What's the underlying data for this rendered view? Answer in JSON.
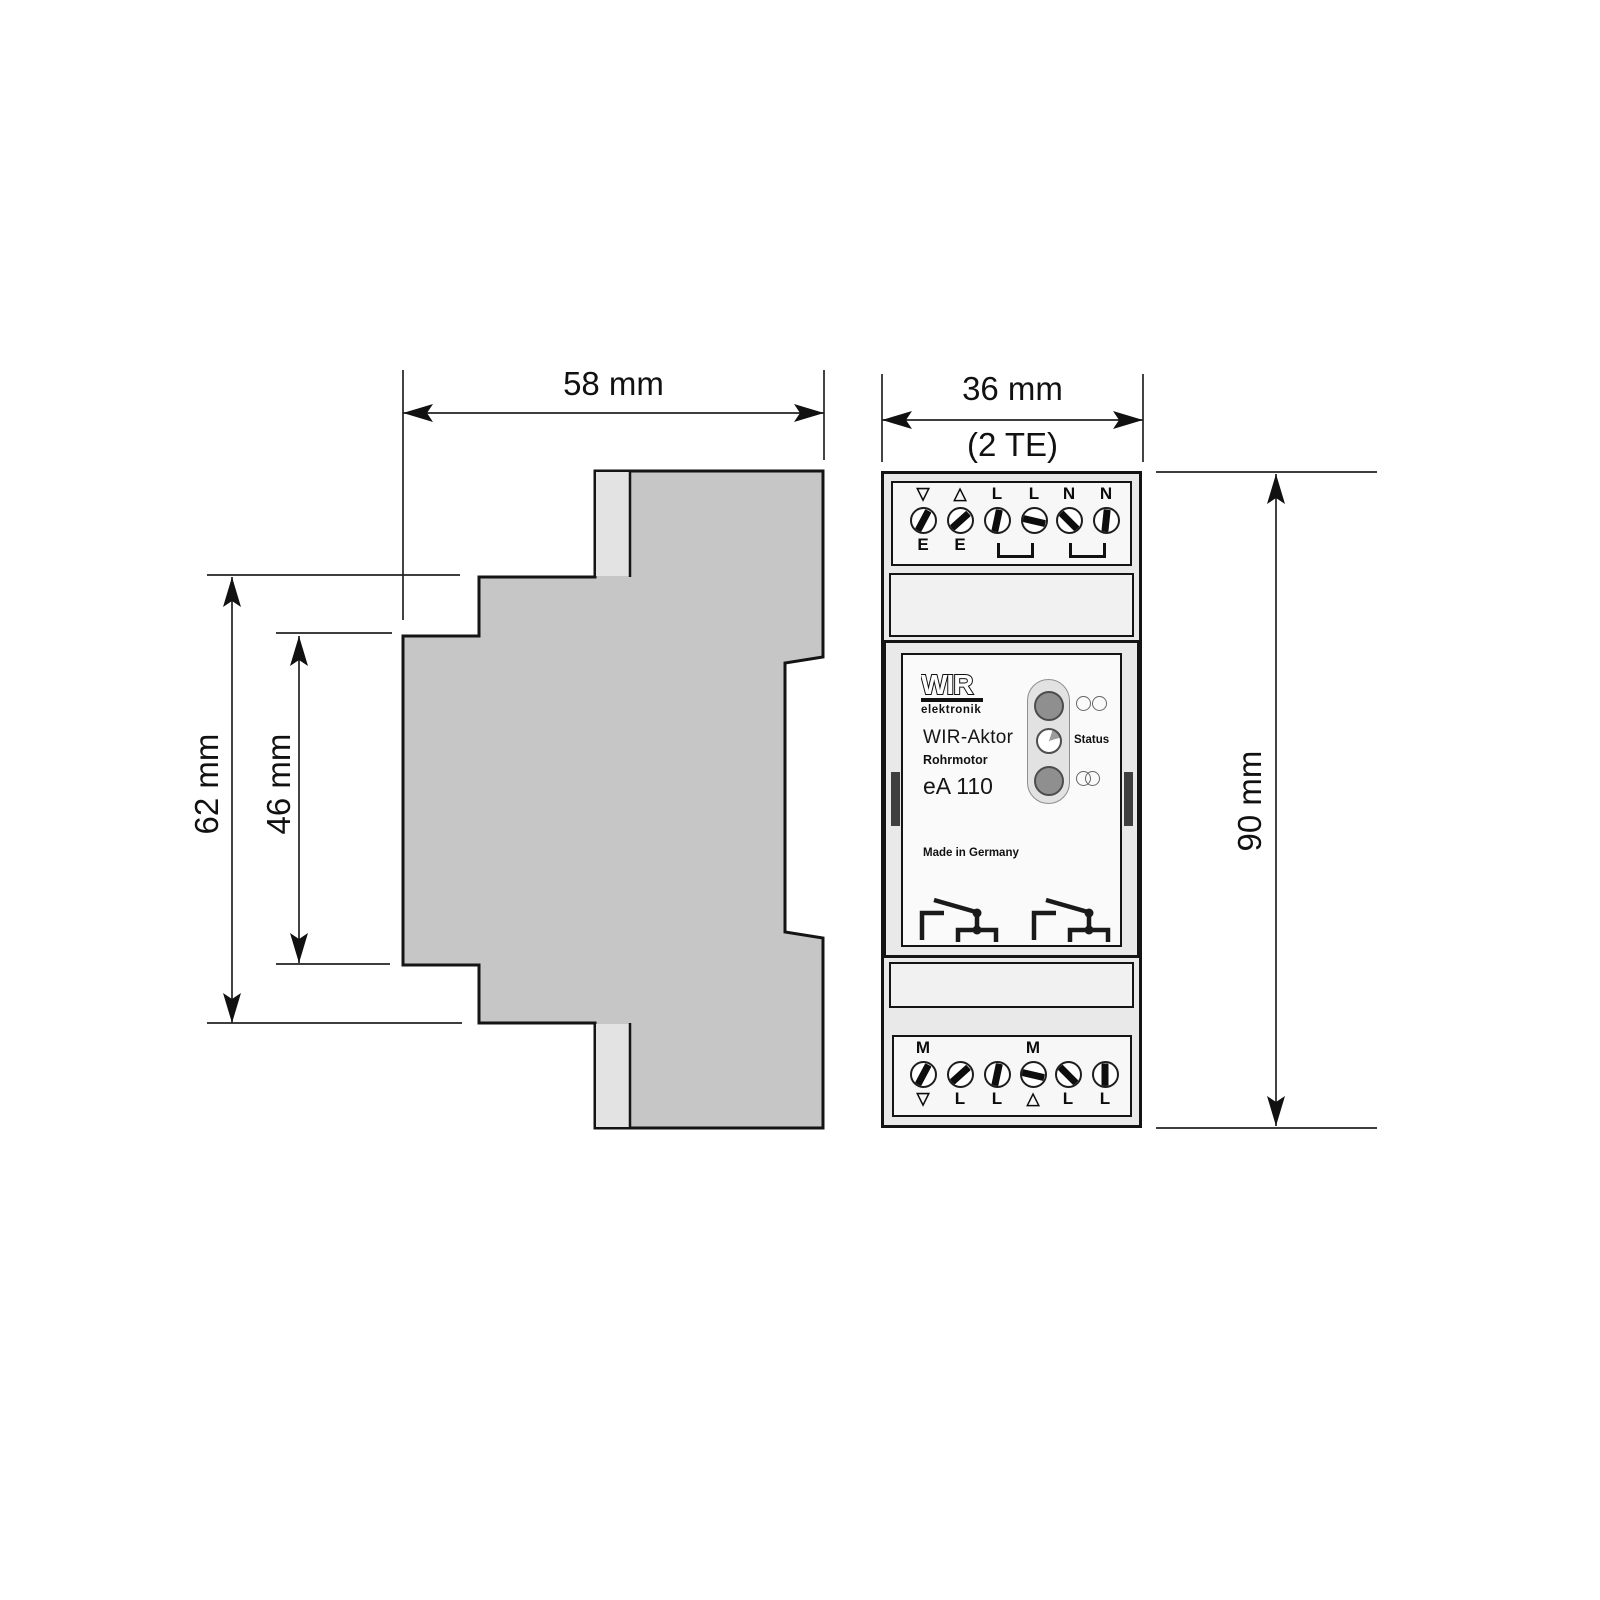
{
  "dimensions": {
    "side_width": "58 mm",
    "side_height_outer": "62 mm",
    "side_height_inner": "46 mm",
    "front_width": "36 mm",
    "front_width_note": "(2 TE)",
    "front_height": "90 mm"
  },
  "device": {
    "brand": "WIR",
    "brand_sub": "elektronik",
    "product": "WIR-Aktor",
    "subtitle": "Rohrmotor",
    "model": "eA 110",
    "made_in": "Made in Germany",
    "status_label": "Status"
  },
  "top_terminals": {
    "above": [
      "▽",
      "△",
      "L",
      "L",
      "N",
      "N"
    ],
    "below": [
      "E",
      "E",
      "",
      "",
      "",
      ""
    ],
    "slot_angles": [
      28,
      48,
      12,
      103,
      -45,
      6
    ]
  },
  "bottom_terminals": {
    "above": [
      "M",
      "",
      "",
      "M",
      "",
      ""
    ],
    "below": [
      "▽",
      "L",
      "L",
      "△",
      "L",
      "L"
    ],
    "slot_angles": [
      28,
      48,
      12,
      103,
      -45,
      0
    ]
  },
  "colors": {
    "profile_fill": "#c6c6c6",
    "profile_light": "#e3e3e3",
    "body_fill": "#e9e9e9",
    "panel_white": "#f7f7f7",
    "led_gray": "#8f8f8f",
    "outline": "#141414"
  }
}
